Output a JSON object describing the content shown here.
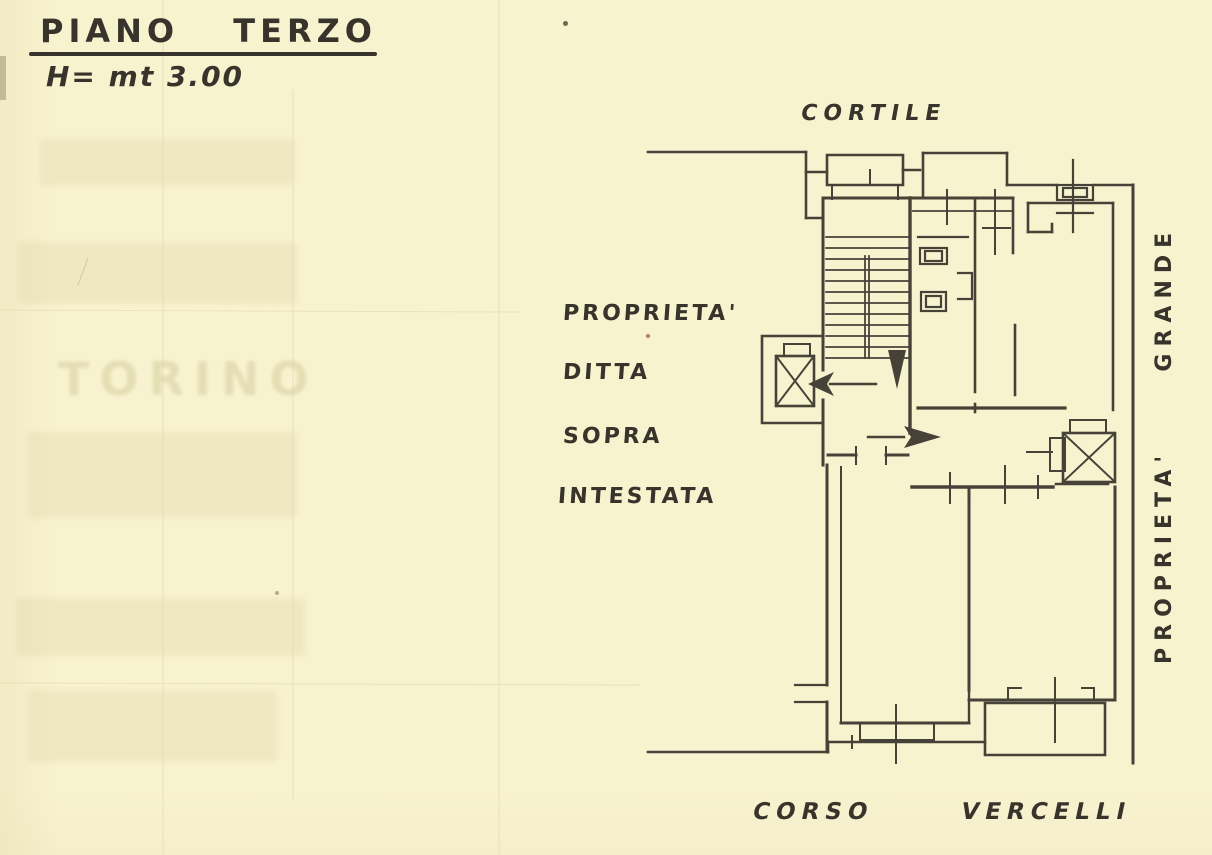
{
  "document": {
    "title": "PIANO TERZO",
    "height_note": "H= mt 3.00",
    "labels": {
      "top": "CORTILE",
      "left_lines": [
        "PROPRIETA'",
        "DITTA",
        "SOPRA",
        "INTESTATA"
      ],
      "right_vertical": "PROPRIETA'  GRANDE",
      "bottom": "CORSO  VERCELLI"
    },
    "ghost_text": "TORINO",
    "colors": {
      "paper": "#f8f3cf",
      "ink": "#38342c",
      "faint": "#b9ae7e"
    }
  }
}
